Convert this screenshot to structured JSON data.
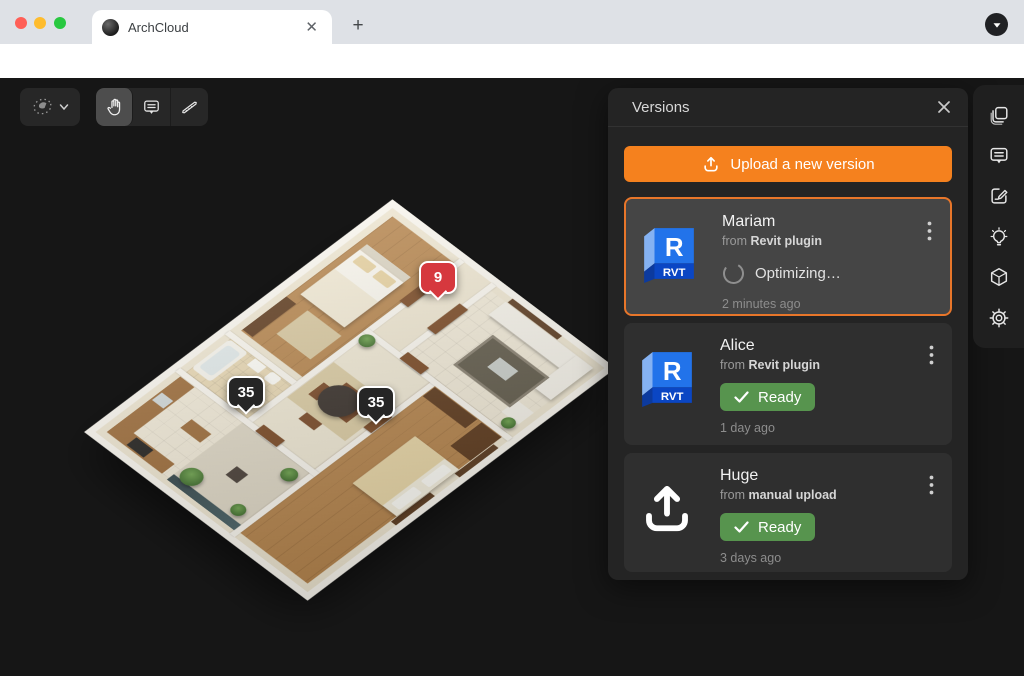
{
  "browser": {
    "tab_title": "ArchCloud",
    "url_domain": "archcloud.app",
    "url_path": "/projects/bGkkIWjtNXhf4zsEgSfU"
  },
  "canvas": {
    "markers": [
      {
        "label": "9",
        "type": "comment-pin-red"
      },
      {
        "label": "35",
        "type": "measure-pin-dark"
      },
      {
        "label": "35",
        "type": "measure-pin-dark"
      }
    ]
  },
  "panel": {
    "title": "Versions",
    "upload_button": "Upload a new version",
    "versions": [
      {
        "name": "Mariam",
        "source_prefix": "from",
        "source": "Revit plugin",
        "file_type": "RVT",
        "status": "Optimizing…",
        "status_type": "processing",
        "time": "2 minutes ago",
        "selected": true
      },
      {
        "name": "Alice",
        "source_prefix": "from",
        "source": "Revit plugin",
        "file_type": "RVT",
        "status": "Ready",
        "status_type": "ready",
        "time": "1 day ago",
        "selected": false
      },
      {
        "name": "Huge",
        "source_prefix": "from",
        "source": "manual upload",
        "file_type": "upload",
        "status": "Ready",
        "status_type": "ready",
        "time": "3 days ago",
        "selected": false
      }
    ]
  },
  "icons": {
    "lasso-select-icon": "dotted lasso",
    "chevron-down-icon": "▾",
    "hand-tool-icon": "open hand",
    "comment-tool-icon": "speech bubble",
    "measure-tool-icon": "triangle ruler",
    "close-icon": "✕",
    "upload-icon": "arrow up from tray",
    "check-icon": "✓",
    "spinner-icon": "loading arc",
    "kebab-icon": "⋮",
    "copies-icon": "stacked sheets",
    "comments-icon": "speech bubble lines",
    "markup-icon": "square with pencil",
    "ideas-icon": "lightbulb",
    "model-icon": "3d cube",
    "settings-icon": "gear",
    "back-icon": "←",
    "forward-icon": "→",
    "reload-icon": "⟳",
    "lock-icon": "padlock",
    "star-icon": "☆",
    "plus-icon": "+",
    "caret-down-icon": "▾"
  },
  "colors": {
    "accent_orange": "#f5811e",
    "selected_border": "#e8762a",
    "ready_green": "#57944e",
    "marker_red": "#d6383e",
    "marker_dark": "#262626",
    "panel_bg": "#242424",
    "card_bg": "#2f2f2f",
    "canvas_bg": "#161616",
    "traffic_red": "#ff5f57",
    "traffic_yellow": "#febc2e",
    "traffic_green": "#28c840",
    "revit_blue": "#2273ea"
  }
}
